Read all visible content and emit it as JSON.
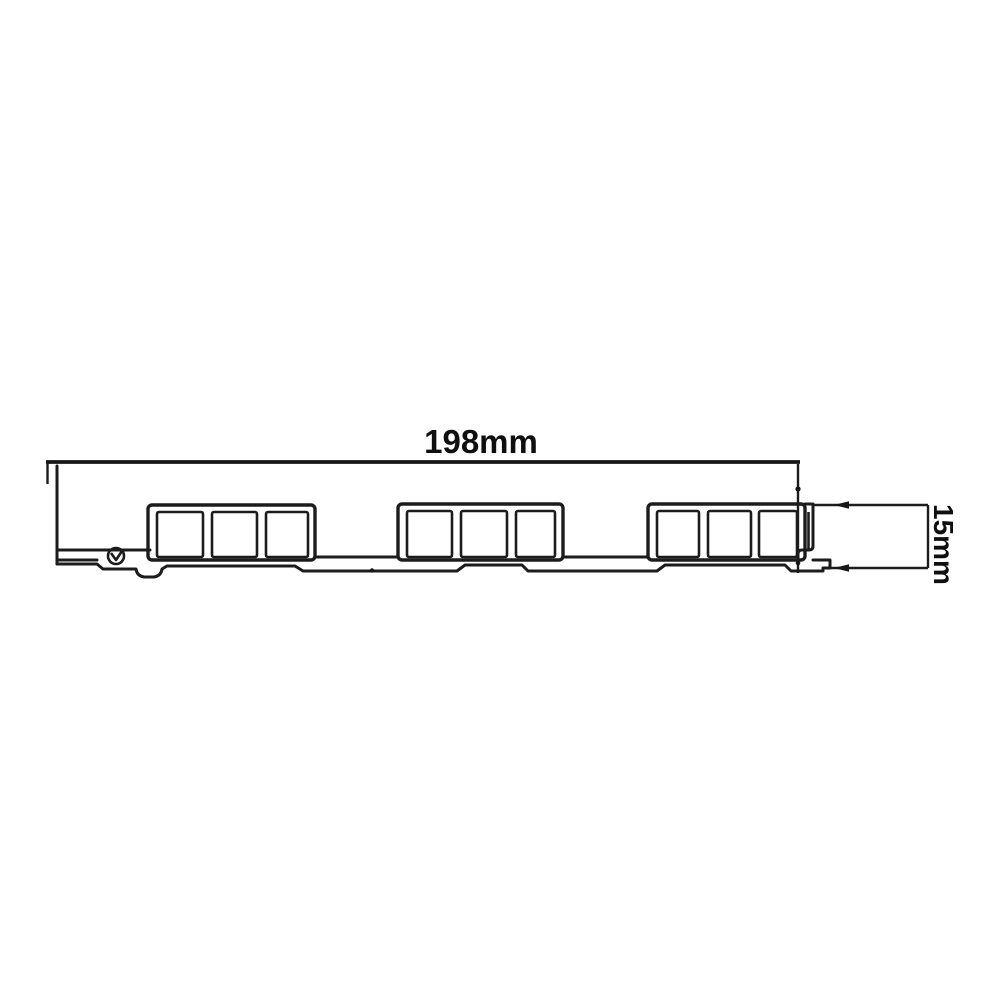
{
  "drawing": {
    "type": "technical cross-section profile",
    "width_label": "198mm",
    "height_label": "15mm"
  },
  "colors": {
    "background": "#ffffff",
    "line": "#1c1c1c",
    "label": "#0f0f0f"
  }
}
